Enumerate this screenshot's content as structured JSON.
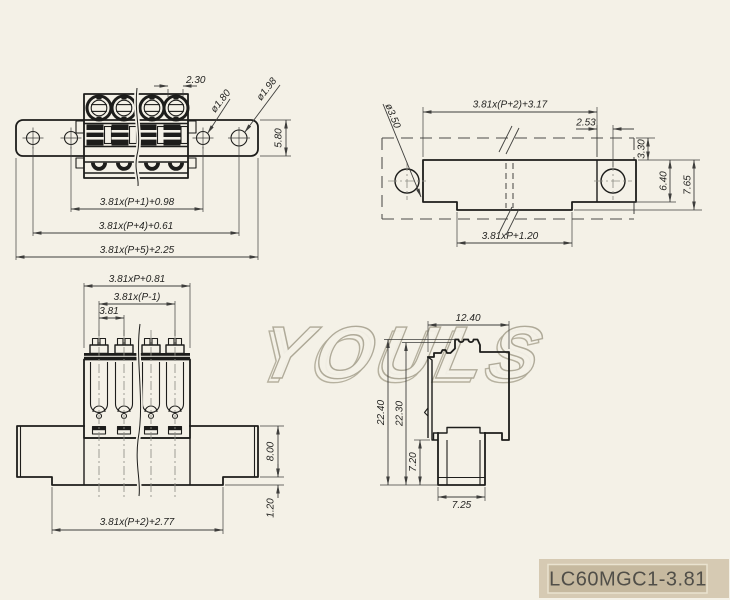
{
  "part": {
    "number": "LC60MGC1-3.81"
  },
  "watermark": {
    "text": "YOULS"
  },
  "views": {
    "top": {
      "dims": {
        "slot_width": "2.30",
        "hole_small": "ø1.80",
        "hole_large": "ø1.98",
        "bar_height": "5.80",
        "span_inner": "3.81x(P+1)+0.98",
        "span_holes": "3.81x(P+4)+0.61",
        "span_total": "3.81x(P+5)+2.25"
      }
    },
    "footprint": {
      "dims": {
        "span_top": "3.81x(P+2)+3.17",
        "hole_offset": "2.53",
        "hole_dia": "ø3.50",
        "edge_margin": "3.30",
        "body_height": "6.40",
        "total_height": "7.65",
        "span_bottom": "3.81xP+1.20"
      }
    },
    "front": {
      "dims": {
        "span_body": "3.81xP+0.81",
        "span_poles": "3.81x(P-1)",
        "pitch": "3.81",
        "wing_height": "8.00",
        "skirt_height": "1.20",
        "span_total": "3.81x(P+2)+2.77"
      }
    },
    "side": {
      "dims": {
        "top_width": "12.40",
        "total_height": "22.40",
        "body_height": "22.30",
        "nose_height": "7.20",
        "nose_width": "7.25"
      }
    }
  },
  "colors": {
    "bg": "#f4f1e7",
    "ink": "#1d1d1b",
    "ink2": "#242422",
    "dim": "#3e3e3c",
    "center": "#8f8f86",
    "dash": "#4c4c48",
    "wm1": "#aca795",
    "wm2": "#9d9782",
    "tbg": "#d6cab3",
    "tpanel": "#c6b99f",
    "tborder": "#eae3d0",
    "ttext": "#504e48"
  }
}
